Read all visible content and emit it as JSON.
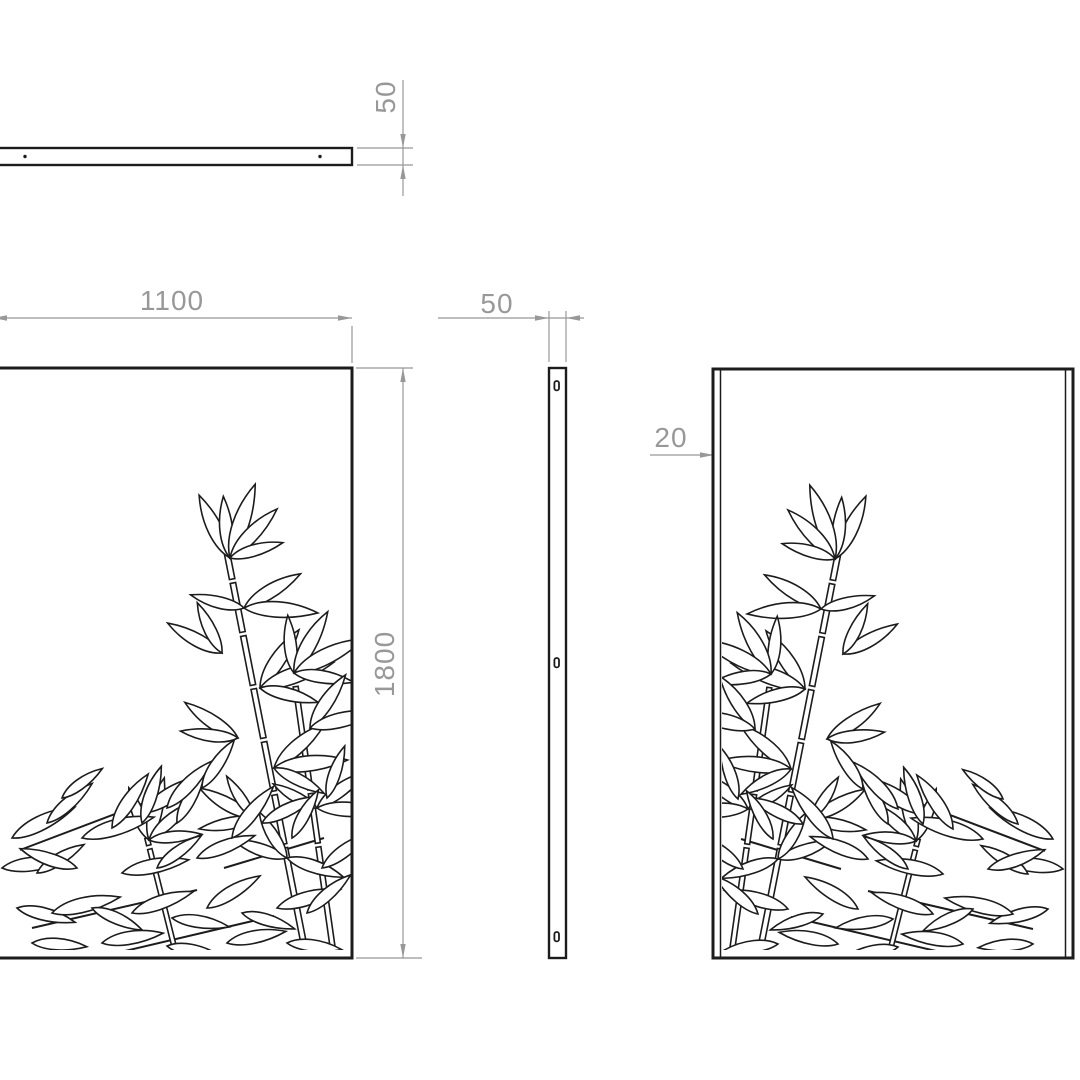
{
  "drawing_labels": {
    "front_width": "1100",
    "front_height": "1800",
    "top_thickness": "50",
    "side_width": "50",
    "flange_depth": "20"
  },
  "colors": {
    "line": "#1c1c1c",
    "dimension": "#989898",
    "background": "#ffffff"
  }
}
